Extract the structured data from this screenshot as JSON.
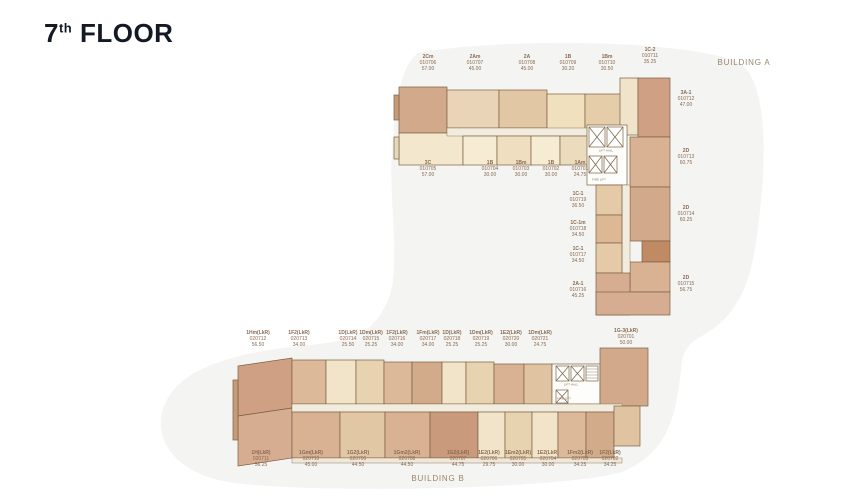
{
  "title": {
    "number": "7",
    "ordinal": "th",
    "rest": " FLOOR"
  },
  "palette": {
    "title_text": "#131a25",
    "unit_label_text": "#8a6a52",
    "building_label_text": "#9d8467",
    "wall": "#7b6044",
    "corridor": "#f2ecdf",
    "background_blob": "#f4f4f2",
    "unit_cream": "#f4e9d1",
    "unit_tan": "#ddbd9c",
    "unit_dark_tan": "#d2ab8b",
    "unit_pink_tan": "#c99a7b"
  },
  "buildings": {
    "a": {
      "label": "BUILDING A"
    },
    "b": {
      "label": "BUILDING B"
    }
  },
  "unit_labels": [
    {
      "building": "A",
      "name": "2Cm",
      "no": "010706",
      "area": "57.00",
      "x": 428,
      "y": 54
    },
    {
      "building": "A",
      "name": "2Am",
      "no": "010707",
      "area": "45.00",
      "x": 475,
      "y": 54
    },
    {
      "building": "A",
      "name": "2A",
      "no": "010708",
      "area": "45.00",
      "x": 527,
      "y": 54
    },
    {
      "building": "A",
      "name": "1B",
      "no": "010709",
      "area": "30.20",
      "x": 568,
      "y": 54
    },
    {
      "building": "A",
      "name": "1Bm",
      "no": "010710",
      "area": "30.50",
      "x": 607,
      "y": 54
    },
    {
      "building": "A",
      "name": "1C-2",
      "no": "010711",
      "area": "35.25",
      "x": 650,
      "y": 47
    },
    {
      "building": "A",
      "name": "3C",
      "no": "010705",
      "area": "57.00",
      "x": 428,
      "y": 160
    },
    {
      "building": "A",
      "name": "1B",
      "no": "010704",
      "area": "30.00",
      "x": 490,
      "y": 160
    },
    {
      "building": "A",
      "name": "1Bm",
      "no": "010703",
      "area": "30.00",
      "x": 521,
      "y": 160
    },
    {
      "building": "A",
      "name": "1B",
      "no": "010702",
      "area": "30.00",
      "x": 551,
      "y": 160
    },
    {
      "building": "A",
      "name": "1Am",
      "no": "010701",
      "area": "24.75",
      "x": 580,
      "y": 160
    },
    {
      "building": "A",
      "name": "3A-1",
      "no": "010712",
      "area": "47.00",
      "x": 686,
      "y": 90
    },
    {
      "building": "A",
      "name": "2D",
      "no": "010713",
      "area": "60.75",
      "x": 686,
      "y": 148
    },
    {
      "building": "A",
      "name": "2D",
      "no": "010714",
      "area": "60.25",
      "x": 686,
      "y": 205
    },
    {
      "building": "A",
      "name": "2D",
      "no": "010715",
      "area": "56.75",
      "x": 686,
      "y": 275
    },
    {
      "building": "A",
      "name": "1C-1",
      "no": "010719",
      "area": "36.50",
      "x": 578,
      "y": 191
    },
    {
      "building": "A",
      "name": "1C-1m",
      "no": "010718",
      "area": "34.50",
      "x": 578,
      "y": 220
    },
    {
      "building": "A",
      "name": "1C-1",
      "no": "010717",
      "area": "34.50",
      "x": 578,
      "y": 246
    },
    {
      "building": "A",
      "name": "2A-1",
      "no": "010716",
      "area": "45.25",
      "x": 578,
      "y": 281
    },
    {
      "building": "B",
      "name": "1Hm(LkR)",
      "no": "020712",
      "area": "56.50",
      "x": 258,
      "y": 330
    },
    {
      "building": "B",
      "name": "1F2(LkR)",
      "no": "020713",
      "area": "34.00",
      "x": 299,
      "y": 330
    },
    {
      "building": "B",
      "name": "1D(LkR)",
      "no": "020714",
      "area": "25.50",
      "x": 348,
      "y": 330
    },
    {
      "building": "B",
      "name": "1Dm(LkR)",
      "no": "020715",
      "area": "25.25",
      "x": 371,
      "y": 330
    },
    {
      "building": "B",
      "name": "1F2(LkR)",
      "no": "020716",
      "area": "34.00",
      "x": 397,
      "y": 330
    },
    {
      "building": "B",
      "name": "1Fm(LkR)",
      "no": "020717",
      "area": "34.00",
      "x": 428,
      "y": 330
    },
    {
      "building": "B",
      "name": "1D(LkR)",
      "no": "020718",
      "area": "25.25",
      "x": 452,
      "y": 330
    },
    {
      "building": "B",
      "name": "1Dm(LkR)",
      "no": "020719",
      "area": "25.25",
      "x": 481,
      "y": 330
    },
    {
      "building": "B",
      "name": "1E2(LkR)",
      "no": "020720",
      "area": "30.00",
      "x": 511,
      "y": 330
    },
    {
      "building": "B",
      "name": "1Dm(LkR)",
      "no": "020721",
      "area": "24.75",
      "x": 540,
      "y": 330
    },
    {
      "building": "B",
      "name": "1G-3(LkR)",
      "no": "020701",
      "area": "50.00",
      "x": 626,
      "y": 328
    },
    {
      "building": "B",
      "name": "1H(LkR)",
      "no": "020711",
      "area": "56.25",
      "x": 261,
      "y": 450
    },
    {
      "building": "B",
      "name": "1Gm(LkR)",
      "no": "020710",
      "area": "45.00",
      "x": 311,
      "y": 450
    },
    {
      "building": "B",
      "name": "1G2(LkR)",
      "no": "020709",
      "area": "44.50",
      "x": 358,
      "y": 450
    },
    {
      "building": "B",
      "name": "1Gm2(LkR)",
      "no": "020708",
      "area": "44.50",
      "x": 407,
      "y": 450
    },
    {
      "building": "B",
      "name": "1G2(LkR)",
      "no": "020707",
      "area": "44.75",
      "x": 458,
      "y": 450
    },
    {
      "building": "B",
      "name": "1E2(LkR)",
      "no": "020706",
      "area": "29.75",
      "x": 489,
      "y": 450
    },
    {
      "building": "B",
      "name": "1Em2(LkR)",
      "no": "020705",
      "area": "30.00",
      "x": 518,
      "y": 450
    },
    {
      "building": "B",
      "name": "1E2(LkR)",
      "no": "020704",
      "area": "30.00",
      "x": 548,
      "y": 450
    },
    {
      "building": "B",
      "name": "1Fm2(LkR)",
      "no": "020703",
      "area": "34.25",
      "x": 580,
      "y": 450
    },
    {
      "building": "B",
      "name": "1F2(LkR)",
      "no": "020702",
      "area": "34.25",
      "x": 610,
      "y": 450
    }
  ],
  "core_labels": [
    {
      "text": "LIFT HALL",
      "x": 606,
      "y": 151
    },
    {
      "text": "FIRE LIFT",
      "x": 599,
      "y": 180
    },
    {
      "text": "LIFT HALL",
      "x": 571,
      "y": 385
    },
    {
      "text": "FIRE LIFT",
      "x": 564,
      "y": 399
    }
  ]
}
